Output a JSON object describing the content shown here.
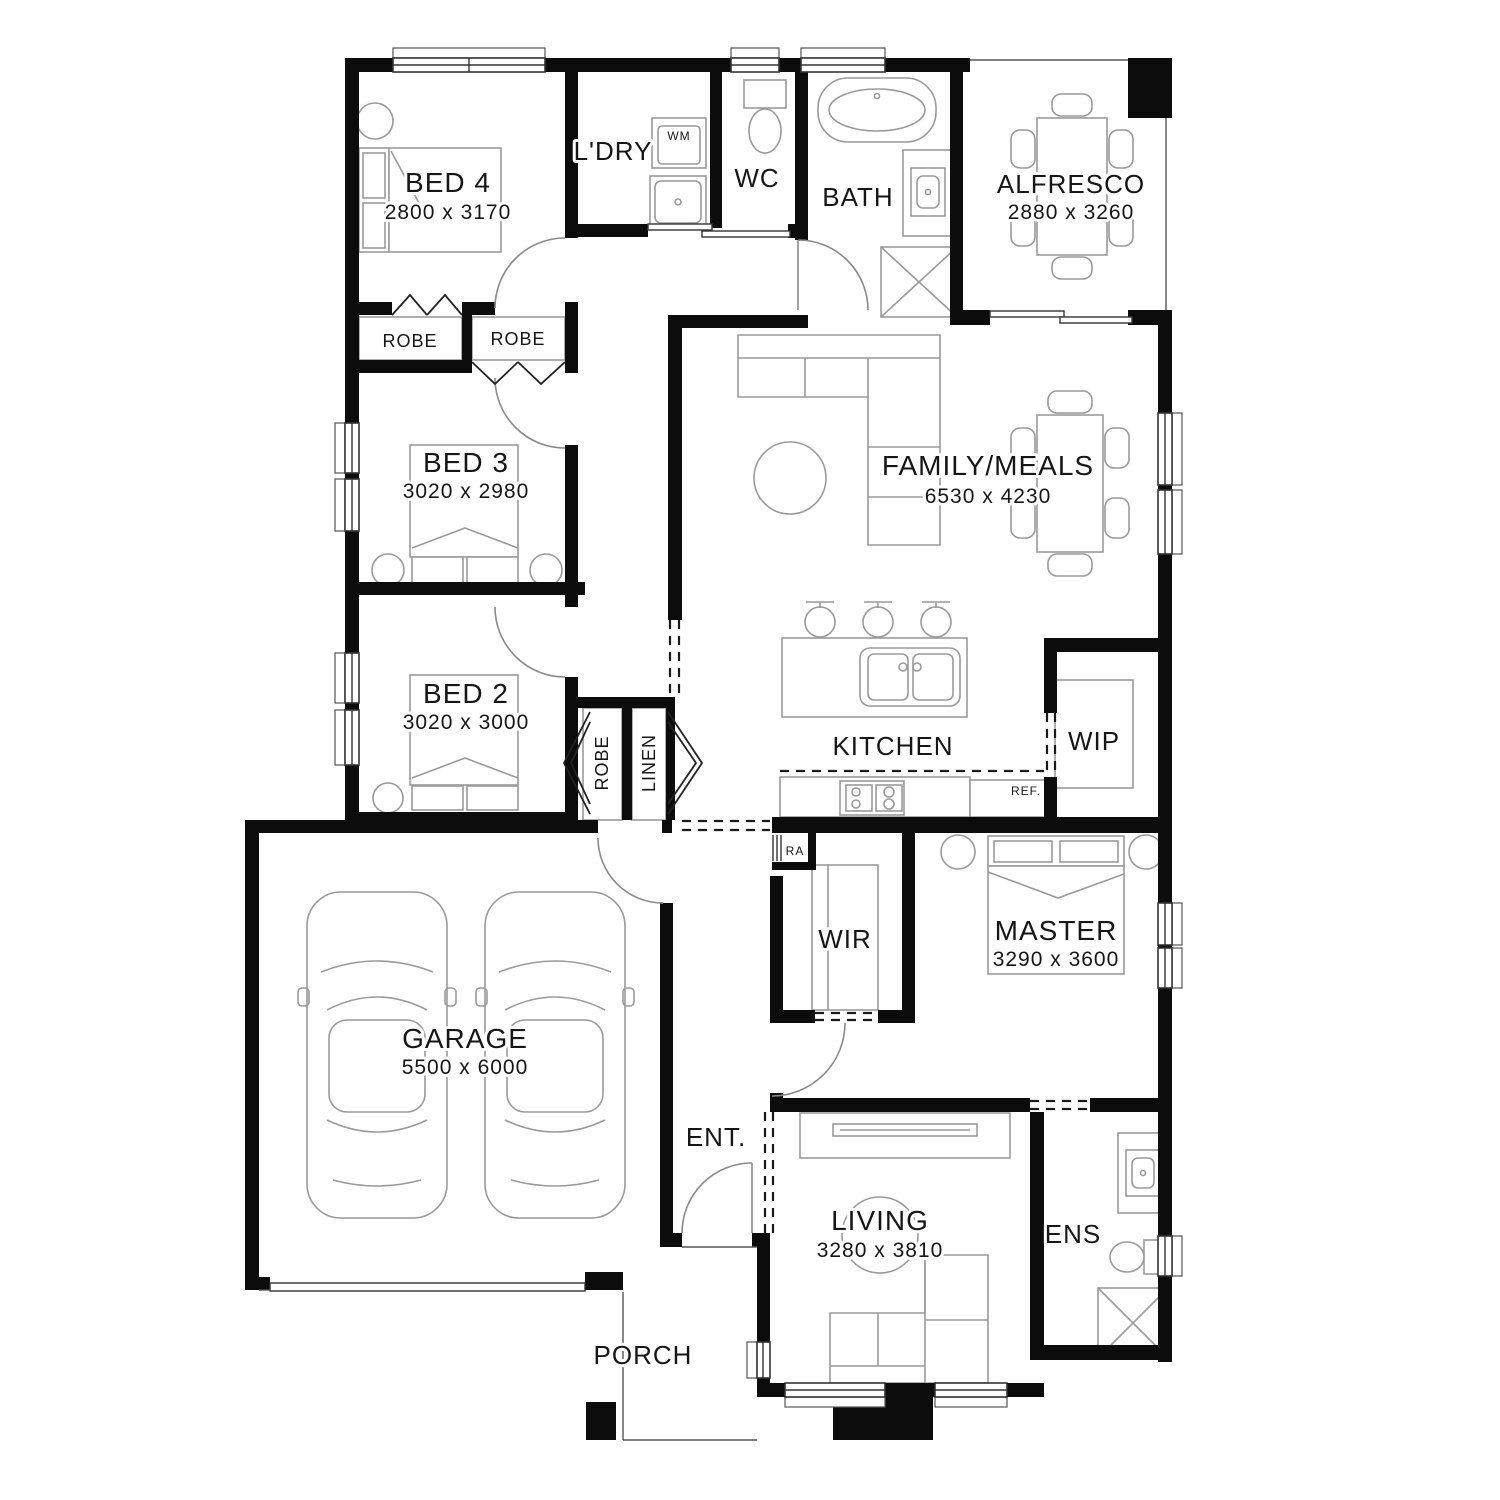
{
  "plan": {
    "title": "single-storey house floor plan",
    "colors": {
      "wall": "#0c0c0c",
      "fixture": "#9a9a9a",
      "paper": "#ffffff",
      "text": "#161616"
    },
    "rooms": {
      "bed4": {
        "name": "BED 4",
        "dims": "2800 x 3170"
      },
      "ldry": {
        "name": "L'DRY"
      },
      "wc": {
        "name": "WC"
      },
      "bath": {
        "name": "BATH"
      },
      "alfresco": {
        "name": "ALFRESCO",
        "dims": "2880 x 3260"
      },
      "family": {
        "name": "FAMILY/MEALS",
        "dims": "6530 x 4230"
      },
      "bed3": {
        "name": "BED 3",
        "dims": "3020 x 2980"
      },
      "bed2": {
        "name": "BED 2",
        "dims": "3020 x 3000"
      },
      "kitchen": {
        "name": "KITCHEN"
      },
      "wip": {
        "name": "WIP"
      },
      "garage": {
        "name": "GARAGE",
        "dims": "5500 x 6000"
      },
      "wir": {
        "name": "WIR"
      },
      "master": {
        "name": "MASTER",
        "dims": "3290 x 3600"
      },
      "ent": {
        "name": "ENT."
      },
      "living": {
        "name": "LIVING",
        "dims": "3280 x 3810"
      },
      "ens": {
        "name": "ENS"
      },
      "porch": {
        "name": "PORCH"
      }
    },
    "closets": {
      "robe_bed4": "ROBE",
      "robe_bed3": "ROBE",
      "robe_hall": "ROBE",
      "linen": "LINEN"
    },
    "appliances": {
      "wm": "WM",
      "ref": "REF.",
      "ra": "RA"
    }
  }
}
